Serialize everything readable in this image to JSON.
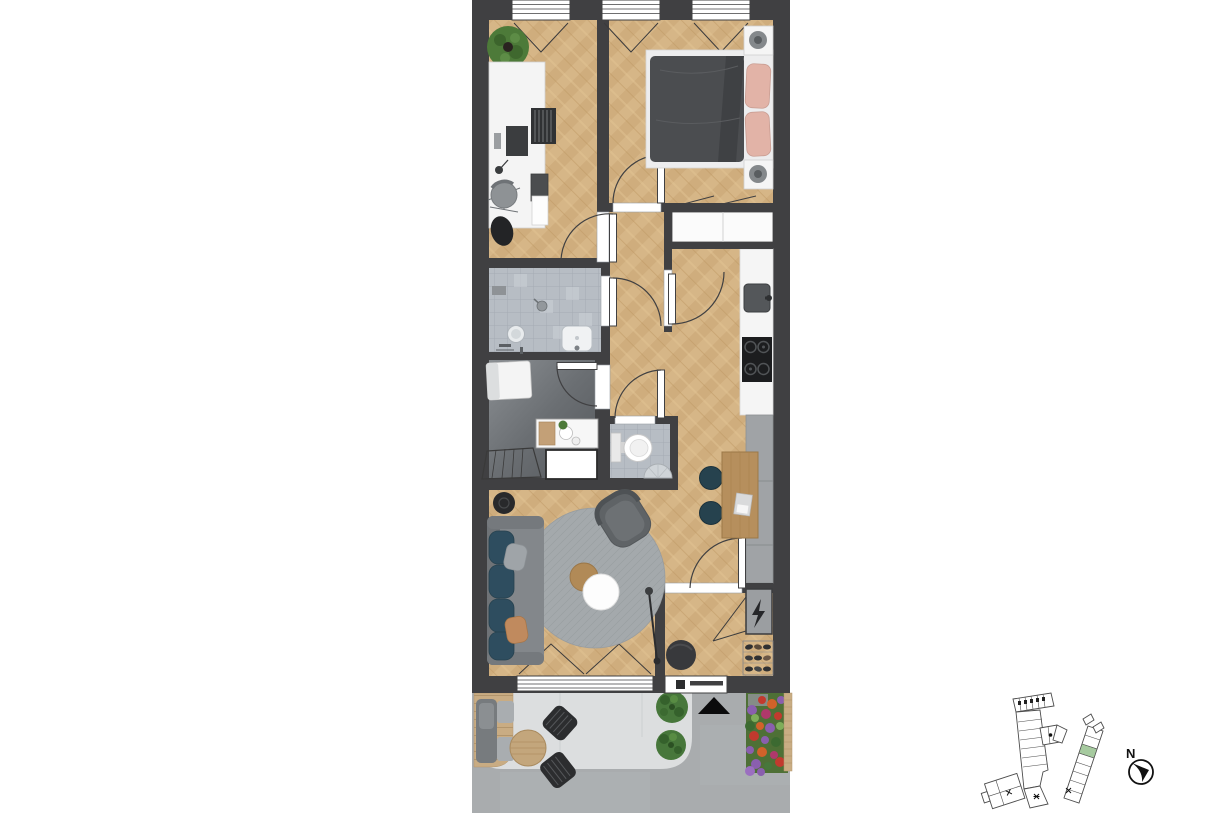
{
  "image": {
    "kind": "apartment-floor-plan-top-view-render",
    "background": "#ffffff"
  },
  "compass": {
    "label": "N"
  },
  "palette": {
    "wall": "#404042",
    "wood_floor": "#d5b485",
    "tile_floor": "#b7bdc4",
    "utility_floor": "#64686c",
    "kitchen_counter": "#f5f5f5",
    "kitchen_cabinets_grey": "#a0a3a6",
    "terrace_slab": "#dcdedf",
    "pavement": "#a9acae",
    "deck_wood": "#c9ac83",
    "sofa_teal": "#2e4d5f",
    "pillow_pink": "#e2b3a7",
    "shrub_green": "#47773b",
    "highlighted_unit_green": "#a6ca9f",
    "entrance_marker": "#0b0b0c"
  },
  "floor_plan": {
    "rooms": [
      {
        "name": "office"
      },
      {
        "name": "bedroom"
      },
      {
        "name": "hallway"
      },
      {
        "name": "bathroom"
      },
      {
        "name": "utility-room"
      },
      {
        "name": "wc"
      },
      {
        "name": "kitchen"
      },
      {
        "name": "living-room"
      },
      {
        "name": "entry-hall"
      },
      {
        "name": "terrace"
      }
    ],
    "top_windows": 3,
    "bottom_windows": 1,
    "exterior_doors": 1,
    "interior_doors": 7,
    "furniture": [
      "potted-plant",
      "desk",
      "monitor",
      "office-chair",
      "bag",
      "double-bed",
      "duvet",
      "pillows",
      "nightstand-left",
      "nightstand-right",
      "sliding-wardrobe",
      "shower-head",
      "round-mirror",
      "washbasin",
      "towel",
      "counter",
      "shelf-unit",
      "washing-machine",
      "drying-rack",
      "toilet",
      "corner-sink",
      "kitchen-sink",
      "cooktop-4-burners",
      "tall-cabinets",
      "dining-table",
      "dining-chairs-2",
      "laptop",
      "sofa",
      "round-rug",
      "coffee-table-white",
      "coffee-table-wood",
      "armchair",
      "side-table",
      "floor-lamp",
      "pouf",
      "electrical-cabinet-lightning",
      "shoe-rack",
      "lounge-chair",
      "bistro-table",
      "bistro-chairs-2",
      "shrubs-2",
      "flower-bed",
      "entrance-triangle"
    ]
  },
  "site_plan": {
    "buildings": 2,
    "highlighted_unit": "green",
    "stair_cores_marked": 3
  }
}
